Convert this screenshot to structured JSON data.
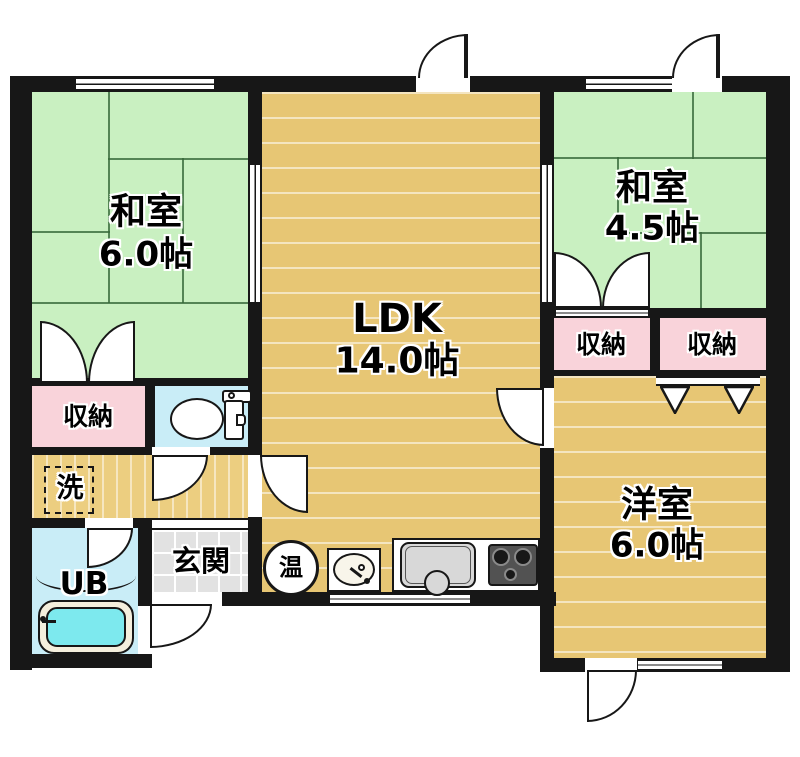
{
  "plan_title": "1LDK+2 floor plan",
  "rooms": {
    "washitsu6": {
      "name": "和室",
      "size": "6.0帖"
    },
    "ldk": {
      "name": "LDK",
      "size": "14.0帖"
    },
    "washitsu45": {
      "name": "和室",
      "size": "4.5帖"
    },
    "youshitsu": {
      "name": "洋室",
      "size": "6.0帖"
    },
    "closet_left": {
      "name": "収納"
    },
    "closet_mid": {
      "name": "収納"
    },
    "closet_right": {
      "name": "収納"
    },
    "laundry": {
      "name": "洗"
    },
    "unit_bath": {
      "name": "UB"
    },
    "genkan": {
      "name": "玄関"
    },
    "water_heater": {
      "name": "温"
    }
  },
  "colors": {
    "tatami_green": "#c9f0c1",
    "wood_tan": "#e7c674",
    "closet_pink": "#f9d3da",
    "wet_area_blue": "#c9edf7",
    "entry_gray": "#e2e2e2",
    "wall_black": "#171717",
    "tub_water_cyan": "#7de9ee"
  }
}
